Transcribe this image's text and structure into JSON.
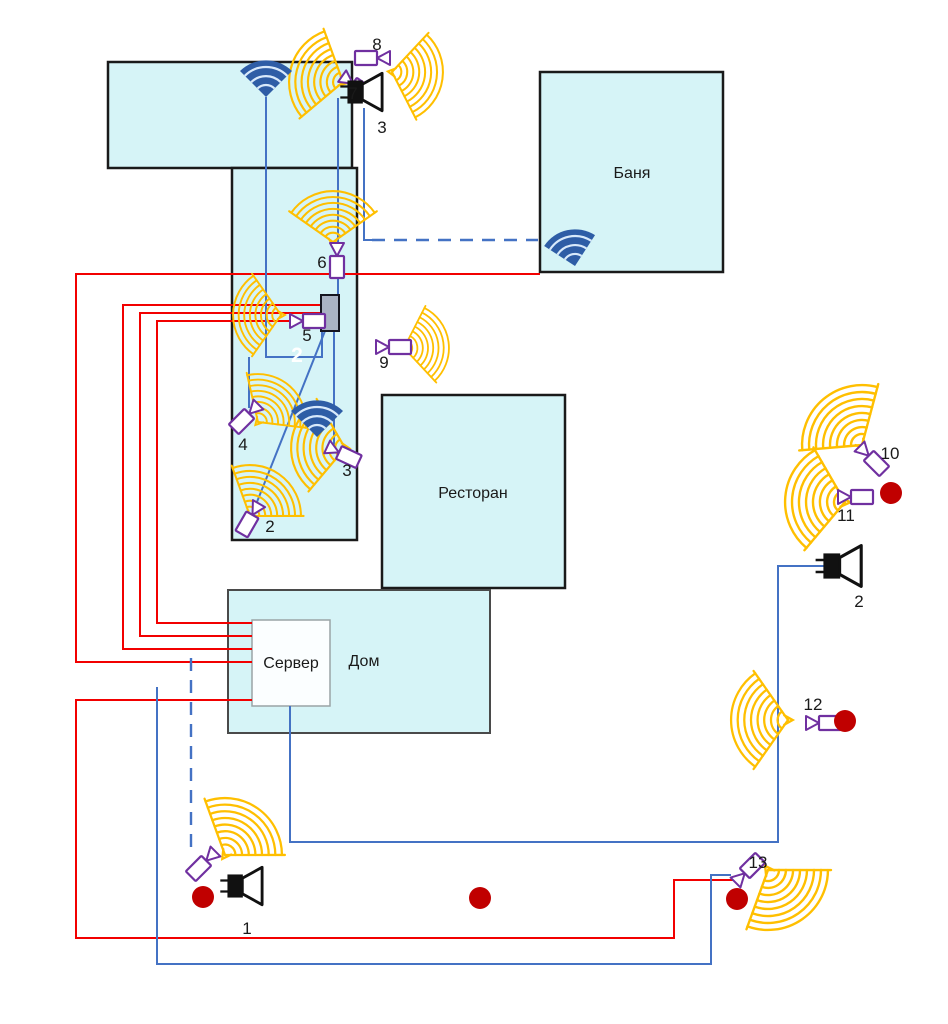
{
  "diagram_title": "Site security and network layout plan",
  "buildings": {
    "banya": "Баня",
    "restaurant": "Ресторан",
    "house": "Дом",
    "server": "Сервер"
  },
  "cameras": {
    "c2": "2",
    "c3": "3",
    "c4": "4",
    "c5": "5",
    "c6": "6",
    "c7": "7",
    "c8": "8",
    "c9": "9",
    "c10": "10",
    "c11": "11",
    "c12": "12",
    "c13": "13"
  },
  "speakers": {
    "s1": "1",
    "s2": "2",
    "s3": "3"
  },
  "zone_labels": {
    "z2": "2"
  },
  "icon_semantics": {
    "camera-icon": "CCTV camera (purple)",
    "coverage-fan-icon": "camera field-of-view sector (orange)",
    "wifi-icon": "wireless access point (blue)",
    "speaker-icon": "loudspeaker / siren (black)",
    "alarm-dot": "red indicator dot",
    "switch-box": "network switch / junction box"
  },
  "line_semantics": {
    "red_solid": "power / alarm cable",
    "blue_solid": "network cable",
    "blue_dashed": "wireless link"
  },
  "colors": {
    "building": "#d6f4f7",
    "outline": "#1a1a1a",
    "power": "#f20000",
    "network": "#4472c4",
    "camera": "#7030a0",
    "coverage": "#ffbf00",
    "wifi": "#2e5da6",
    "alarm": "#c00000",
    "switch": "#a9b2c3"
  }
}
